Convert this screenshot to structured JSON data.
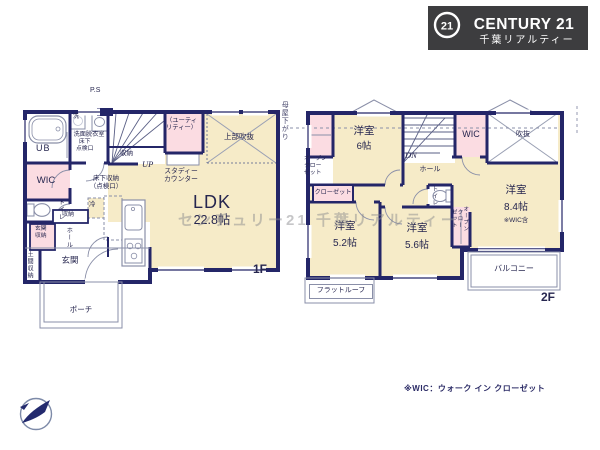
{
  "logo": {
    "badge": "21",
    "brand": "CENTURY 21",
    "company": "千葉リアルティー"
  },
  "f1": {
    "floor": "1F",
    "ps": "P.S",
    "ub": "UB",
    "wash_machine": "洗",
    "washroom": "洗面脱衣室",
    "floor_hatch_small": "床下\n点検口",
    "stair_closet": "収納",
    "up": "UP",
    "utility": "（ユーティ\nリティー）",
    "void_above": "上部吹抜",
    "study_counter": "スタディー\nカウンター",
    "wic": "WIC",
    "toilet": "トイレ",
    "hall_closet": "収納",
    "entry_closet": "玄関\n収納",
    "hall": "ホール",
    "doma_closet": "土間収納",
    "entry": "玄関",
    "fridge": "冷",
    "floor_storage": "床下収納\n（点検口）",
    "ldk": "LDK",
    "ldk_size": "22.8帖",
    "porch": "ポーチ",
    "roof_note": "母屋下がり"
  },
  "f2": {
    "floor": "2F",
    "open_closet_a": "オープン\nクロー\nゼット",
    "room6": "洋室",
    "room6_size": "6帖",
    "dn": "DN",
    "hall": "ホール",
    "wic": "WIC",
    "void": "吹抜",
    "closet": "クローゼット",
    "room52": "洋室",
    "room52_size": "5.2帖",
    "room56": "洋室",
    "room56_size": "5.6帖",
    "toilet": "トイレ",
    "open_closet_b": "オープン\nクロー\nゼット",
    "room84": "洋室",
    "room84_size": "8.4帖",
    "room84_note": "※WIC含",
    "balcony": "バルコニー",
    "flat_roof": "フラットルーフ"
  },
  "footnote": "※WIC：ウォーク イン クローゼット",
  "watermark": "センチュリー21 千葉リアルティー",
  "colors": {
    "wall": "#242668",
    "room_cream": "#f6ebc8",
    "room_pink": "#fbdce2",
    "logo_bg": "#3d3d3f",
    "text_navy": "#26264f"
  }
}
